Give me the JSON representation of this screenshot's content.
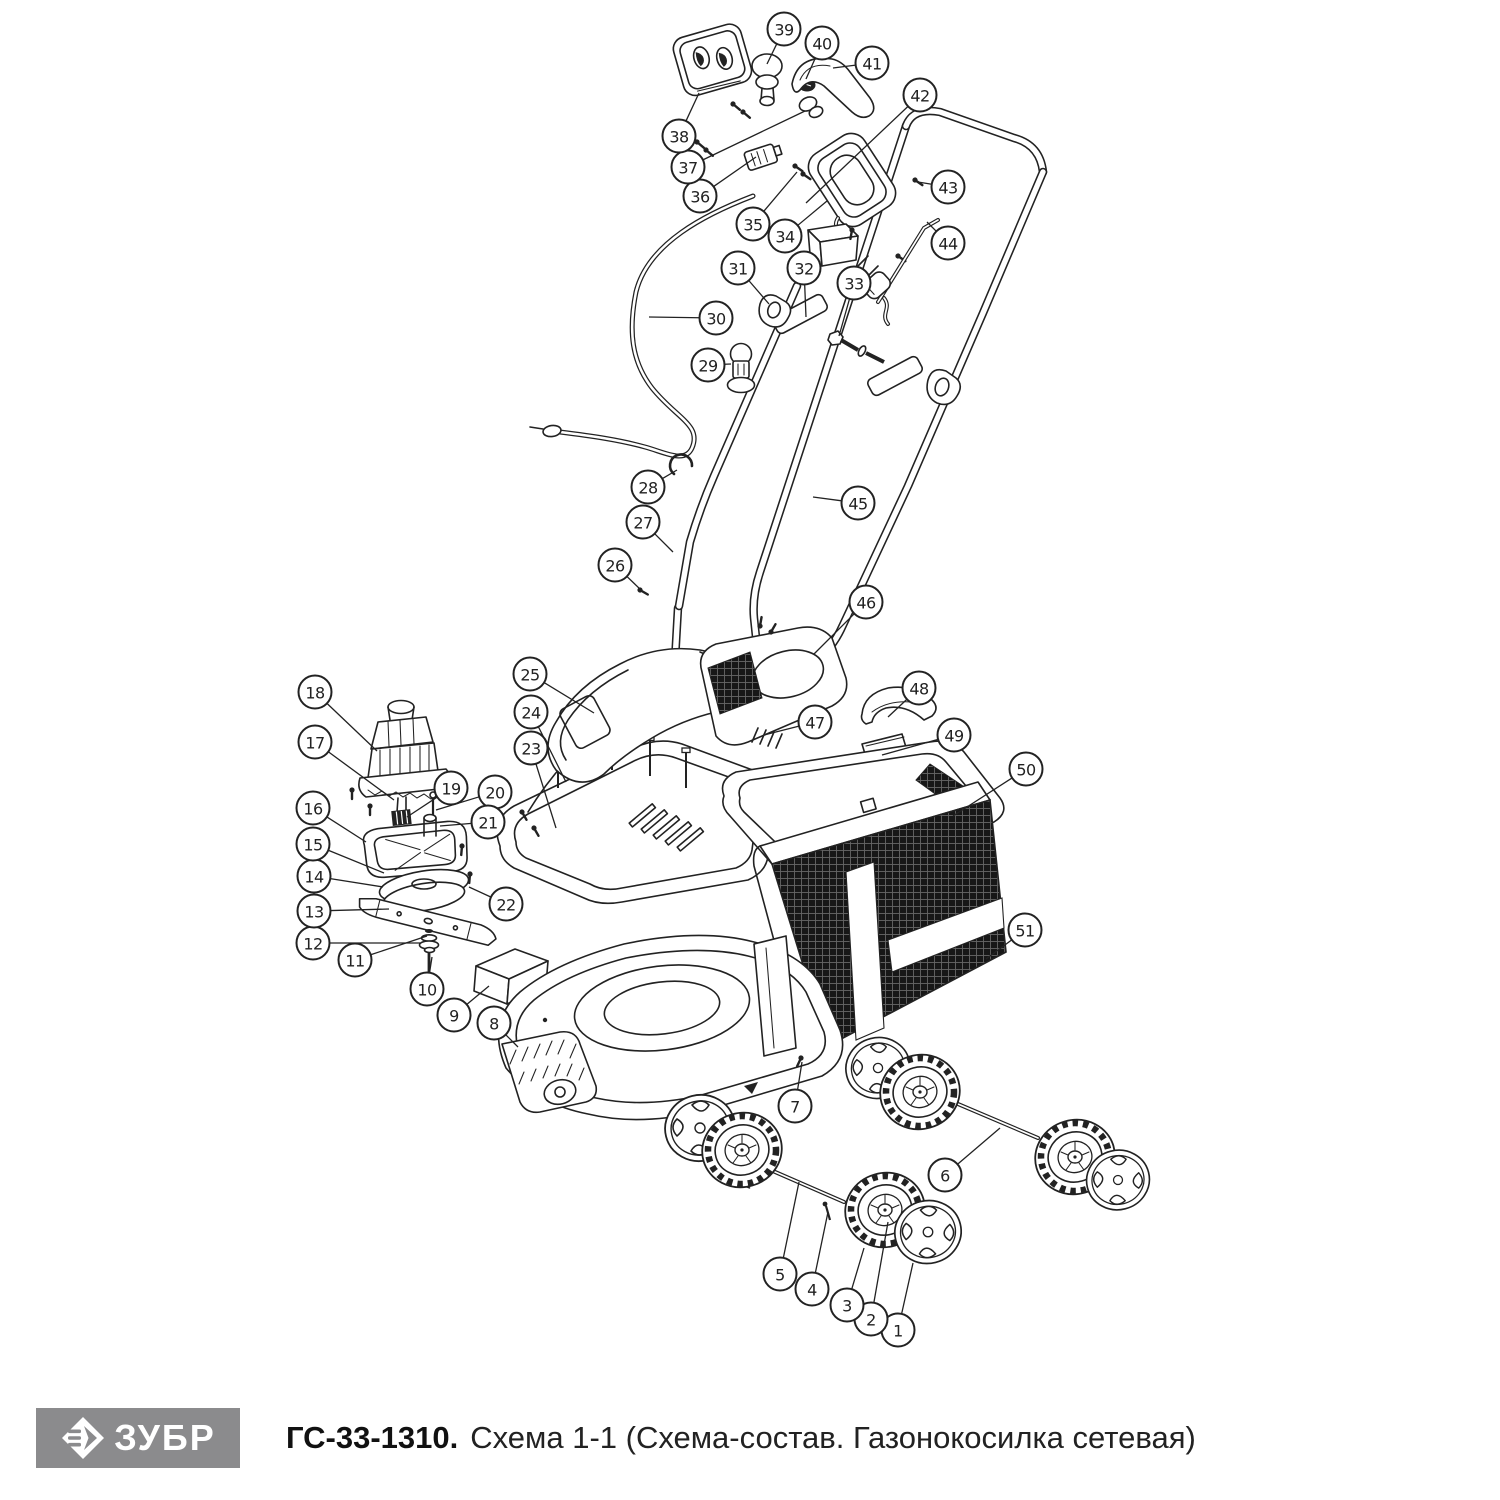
{
  "footer": {
    "logo_text": "ЗУБР",
    "model": "ГС-33-1310.",
    "scheme": "Схема 1-1 (Схема-состав. Газонокосилка сетевая)"
  },
  "colors": {
    "ink": "#222222",
    "logo_bg": "#8b8b8d",
    "logo_fg": "#ffffff",
    "mesh_dark": "#171717"
  },
  "diagram": {
    "description": "Exploded parts view of corded electric lawn mower with 51 numbered callouts",
    "callouts": [
      {
        "n": "1",
        "x": 898,
        "y": 1330,
        "tx": 913,
        "ty": 1263
      },
      {
        "n": "2",
        "x": 871,
        "y": 1319,
        "tx": 888,
        "ty": 1222
      },
      {
        "n": "3",
        "x": 847,
        "y": 1305,
        "tx": 864,
        "ty": 1248
      },
      {
        "n": "4",
        "x": 812,
        "y": 1289,
        "tx": 828,
        "ty": 1212
      },
      {
        "n": "5",
        "x": 780,
        "y": 1274,
        "tx": 799,
        "ty": 1182
      },
      {
        "n": "6",
        "x": 945,
        "y": 1175,
        "tx": 1000,
        "ty": 1128
      },
      {
        "n": "7",
        "x": 795,
        "y": 1106,
        "tx": 802,
        "ty": 1062
      },
      {
        "n": "8",
        "x": 494,
        "y": 1023,
        "tx": 518,
        "ty": 1047
      },
      {
        "n": "9",
        "x": 454,
        "y": 1015,
        "tx": 489,
        "ty": 986
      },
      {
        "n": "10",
        "x": 427,
        "y": 989,
        "tx": 432,
        "ty": 957
      },
      {
        "n": "11",
        "x": 355,
        "y": 960,
        "tx": 427,
        "ty": 936
      },
      {
        "n": "12",
        "x": 313,
        "y": 943,
        "tx": 420,
        "ty": 943
      },
      {
        "n": "13",
        "x": 314,
        "y": 911,
        "tx": 389,
        "ty": 909
      },
      {
        "n": "14",
        "x": 314,
        "y": 876,
        "tx": 383,
        "ty": 887
      },
      {
        "n": "15",
        "x": 313,
        "y": 844,
        "tx": 384,
        "ty": 873
      },
      {
        "n": "16",
        "x": 313,
        "y": 808,
        "tx": 366,
        "ty": 842
      },
      {
        "n": "17",
        "x": 315,
        "y": 742,
        "tx": 394,
        "ty": 800
      },
      {
        "n": "18",
        "x": 315,
        "y": 692,
        "tx": 377,
        "ty": 751
      },
      {
        "n": "19",
        "x": 451,
        "y": 788,
        "tx": 407,
        "ty": 817
      },
      {
        "n": "20",
        "x": 495,
        "y": 792,
        "tx": 436,
        "ty": 810
      },
      {
        "n": "21",
        "x": 488,
        "y": 822,
        "tx": 440,
        "ty": 826
      },
      {
        "n": "22",
        "x": 506,
        "y": 904,
        "tx": 469,
        "ty": 887
      },
      {
        "n": "23",
        "x": 531,
        "y": 748,
        "tx": 556,
        "ty": 828
      },
      {
        "n": "24",
        "x": 531,
        "y": 712,
        "tx": 566,
        "ty": 782
      },
      {
        "n": "25",
        "x": 530,
        "y": 674,
        "tx": 594,
        "ty": 713
      },
      {
        "n": "26",
        "x": 615,
        "y": 565,
        "tx": 641,
        "ty": 590
      },
      {
        "n": "27",
        "x": 643,
        "y": 522,
        "tx": 673,
        "ty": 552
      },
      {
        "n": "28",
        "x": 648,
        "y": 487,
        "tx": 677,
        "ty": 470
      },
      {
        "n": "29",
        "x": 708,
        "y": 365,
        "tx": 731,
        "ty": 364
      },
      {
        "n": "30",
        "x": 716,
        "y": 318,
        "tx": 649,
        "ty": 317
      },
      {
        "n": "31",
        "x": 738,
        "y": 268,
        "tx": 769,
        "ty": 304
      },
      {
        "n": "32",
        "x": 804,
        "y": 268,
        "tx": 806,
        "ty": 317
      },
      {
        "n": "33",
        "x": 854,
        "y": 283,
        "tx": 839,
        "ty": 336
      },
      {
        "n": "34",
        "x": 785,
        "y": 236,
        "tx": 827,
        "ty": 201
      },
      {
        "n": "35",
        "x": 753,
        "y": 224,
        "tx": 797,
        "ty": 172
      },
      {
        "n": "36",
        "x": 700,
        "y": 196,
        "tx": 756,
        "ty": 157
      },
      {
        "n": "37",
        "x": 688,
        "y": 167,
        "tx": 805,
        "ty": 111
      },
      {
        "n": "38",
        "x": 679,
        "y": 136,
        "tx": 699,
        "ty": 93
      },
      {
        "n": "39",
        "x": 784,
        "y": 29,
        "tx": 767,
        "ty": 64
      },
      {
        "n": "40",
        "x": 822,
        "y": 43,
        "tx": 806,
        "ty": 79
      },
      {
        "n": "41",
        "x": 872,
        "y": 63,
        "tx": 833,
        "ty": 68
      },
      {
        "n": "42",
        "x": 920,
        "y": 95,
        "tx": 806,
        "ty": 203
      },
      {
        "n": "43",
        "x": 948,
        "y": 187,
        "tx": 918,
        "ty": 182
      },
      {
        "n": "44",
        "x": 948,
        "y": 243,
        "tx": 927,
        "ty": 222
      },
      {
        "n": "45",
        "x": 858,
        "y": 503,
        "tx": 813,
        "ty": 497
      },
      {
        "n": "46",
        "x": 866,
        "y": 602,
        "tx": 814,
        "ty": 654
      },
      {
        "n": "47",
        "x": 815,
        "y": 722,
        "tx": 764,
        "ty": 735
      },
      {
        "n": "48",
        "x": 919,
        "y": 688,
        "tx": 888,
        "ty": 717
      },
      {
        "n": "49",
        "x": 954,
        "y": 735,
        "tx": 882,
        "ty": 755
      },
      {
        "n": "50",
        "x": 1026,
        "y": 769,
        "tx": 953,
        "ty": 816
      },
      {
        "n": "51",
        "x": 1025,
        "y": 930,
        "tx": 986,
        "ty": 959
      }
    ]
  }
}
